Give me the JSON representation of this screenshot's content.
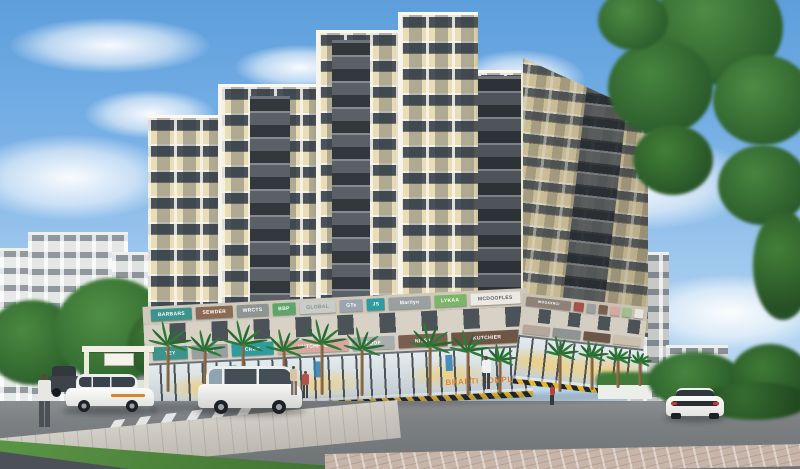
{
  "scene": {
    "type": "architectural-exterior-render",
    "description": "Sunny 3D rendering of a cream nine-storey residential tower with dark balcony stacks, colourful ground-floor retail fascia signs, palm trees, glass shopfronts, a road with cars, crosswalk and pedestrians",
    "complex_name": "BHARTI COMPLEX"
  },
  "palette": {
    "sky_top": "#5d9edc",
    "sky_bottom": "#d2e6f6",
    "building_cream": "#ecdfbd",
    "building_cream_shade": "#e0d3ad",
    "building_accent_dark": "#5a6065",
    "building_white_band": "#f7f4ec",
    "window_dark": "#49515a",
    "road_gray": "#7c8083",
    "grass_green": "#4e8a3d",
    "tree_green": "#35702f",
    "palm_green": "#2e7a37",
    "hazard_yellow": "#e5b62e",
    "hazard_black": "#20242a",
    "name_orange": "#e8821e",
    "glass_warm_glow": "#f4cd6e"
  },
  "signs": {
    "upper": [
      {
        "label": "BARBARS",
        "color": "#3d948c"
      },
      {
        "label": "SEWDER",
        "color": "#8a6a55"
      },
      {
        "label": "WRCTS",
        "color": "#8d9494"
      },
      {
        "label": "BBP",
        "color": "#5fa469"
      },
      {
        "label": "GLOBAL",
        "color": "#c9cdc9",
        "fg": "#8a8f8a"
      },
      {
        "label": "GTs",
        "color": "#9aa5ad"
      },
      {
        "label": "JS",
        "color": "#2f9aa0"
      },
      {
        "label": "Marilyn",
        "color": "#9a9f9f"
      },
      {
        "label": "LYKAA",
        "color": "#7cb567"
      },
      {
        "label": "MCDOOFLES",
        "color": "#ece9e2",
        "fg": "#5a5f64"
      }
    ],
    "lower": [
      {
        "label": "TEY",
        "color": "#3d948c"
      },
      {
        "label": "MET",
        "color": "#9aa0a0"
      },
      {
        "label": "CRUX",
        "color": "#2f9aa0"
      },
      {
        "label": "HUTCHFUL",
        "color": "#d8a8a0"
      },
      {
        "label": "POOF",
        "color": "#a8adad"
      },
      {
        "label": "NITSA",
        "color": "#7a5f4e"
      },
      {
        "label": "KUTCHIER",
        "color": "#6e5647"
      }
    ],
    "right_upper": [
      {
        "label": "WOOXXRCI",
        "color": "#8d8178"
      },
      {
        "label": "",
        "color": "#a4524a"
      },
      {
        "label": "",
        "color": "#9aa0a0"
      },
      {
        "label": "",
        "color": "#7a5f4e"
      },
      {
        "label": "",
        "color": "#d8a8a0"
      },
      {
        "label": "",
        "color": "#9fc08a"
      },
      {
        "label": "",
        "color": "#e8e5dc"
      }
    ],
    "right_lower": [
      {
        "label": "",
        "color": "#b4a89a"
      },
      {
        "label": "",
        "color": "#8d9494"
      },
      {
        "label": "",
        "color": "#6e5647"
      },
      {
        "label": "",
        "color": "#cdbfae"
      }
    ]
  },
  "vehicles": [
    {
      "type": "dark-suv",
      "color": "#3d4349"
    },
    {
      "type": "white-mpv",
      "color": "#f6f6f4"
    },
    {
      "type": "silver-minivan",
      "color": "#ededeb"
    },
    {
      "type": "white-coupe",
      "color": "#f6f6f4"
    }
  ],
  "figures": [
    {
      "role": "man-walking-foreground",
      "shirt": "#e9e7e3",
      "pants": "#4b4f56"
    },
    {
      "role": "woman-near-shops",
      "shirt": "#d9c4a2",
      "pants": "#7a6f63"
    },
    {
      "role": "companion-near-shops",
      "shirt": "#b2524a",
      "pants": "#3e434a"
    },
    {
      "role": "man-near-entrance",
      "shirt": "#f0f2f2",
      "pants": "#3e434a"
    },
    {
      "role": "child-in-red",
      "shirt": "#c23f30",
      "pants": "#35393f"
    }
  ]
}
